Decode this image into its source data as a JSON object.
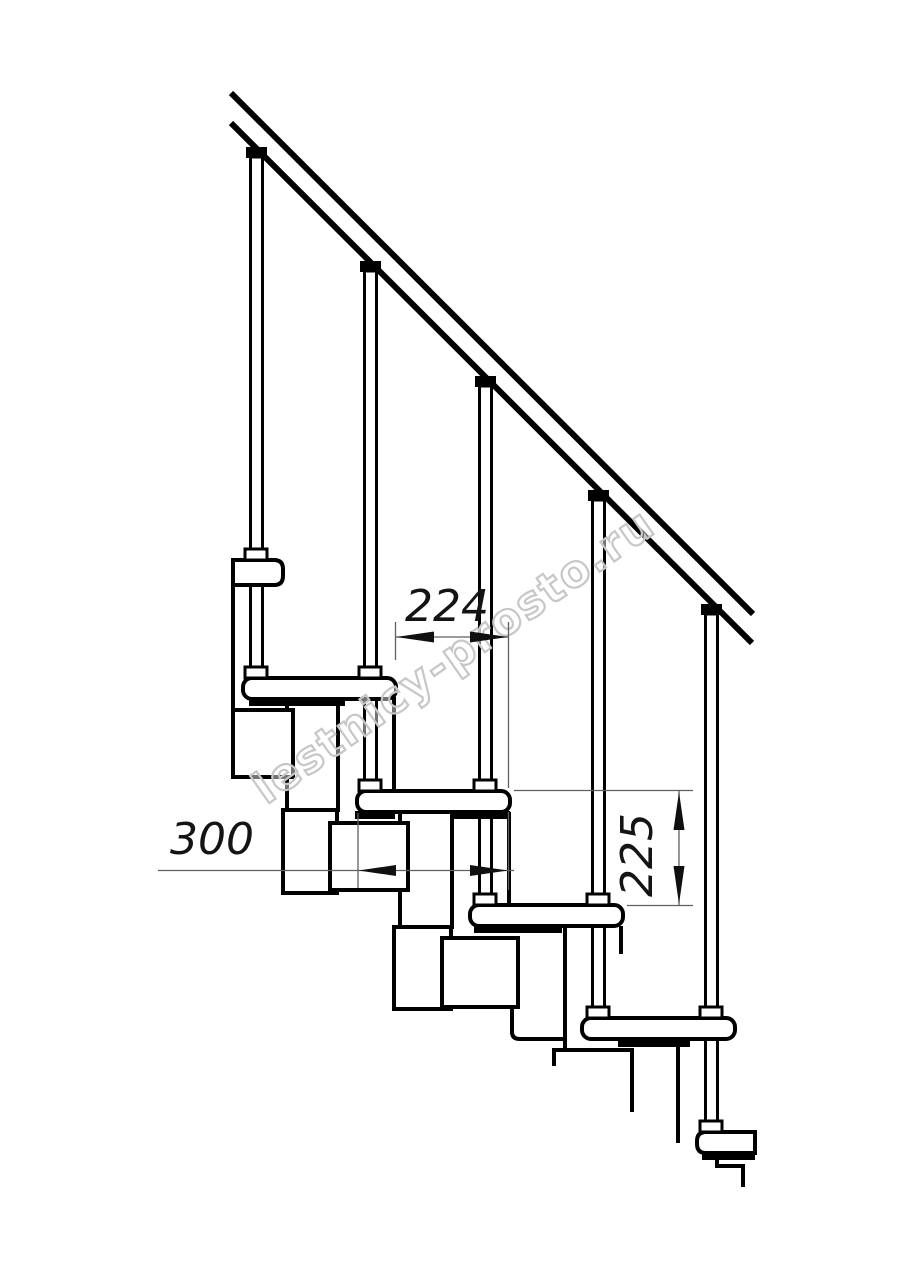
{
  "drawing": {
    "kind": "technical-drawing",
    "subject": "modular staircase side elevation",
    "background_color": "#ffffff",
    "line_color": "#000000",
    "dimension_line_color": "#5f5f5f",
    "dimension_text_color": "#141414",
    "dimensions": {
      "run": "224",
      "depth": "300",
      "rise": "225"
    },
    "watermark": {
      "text": "lestnicy-prosto.ru",
      "color": "#c7c7c7"
    }
  }
}
